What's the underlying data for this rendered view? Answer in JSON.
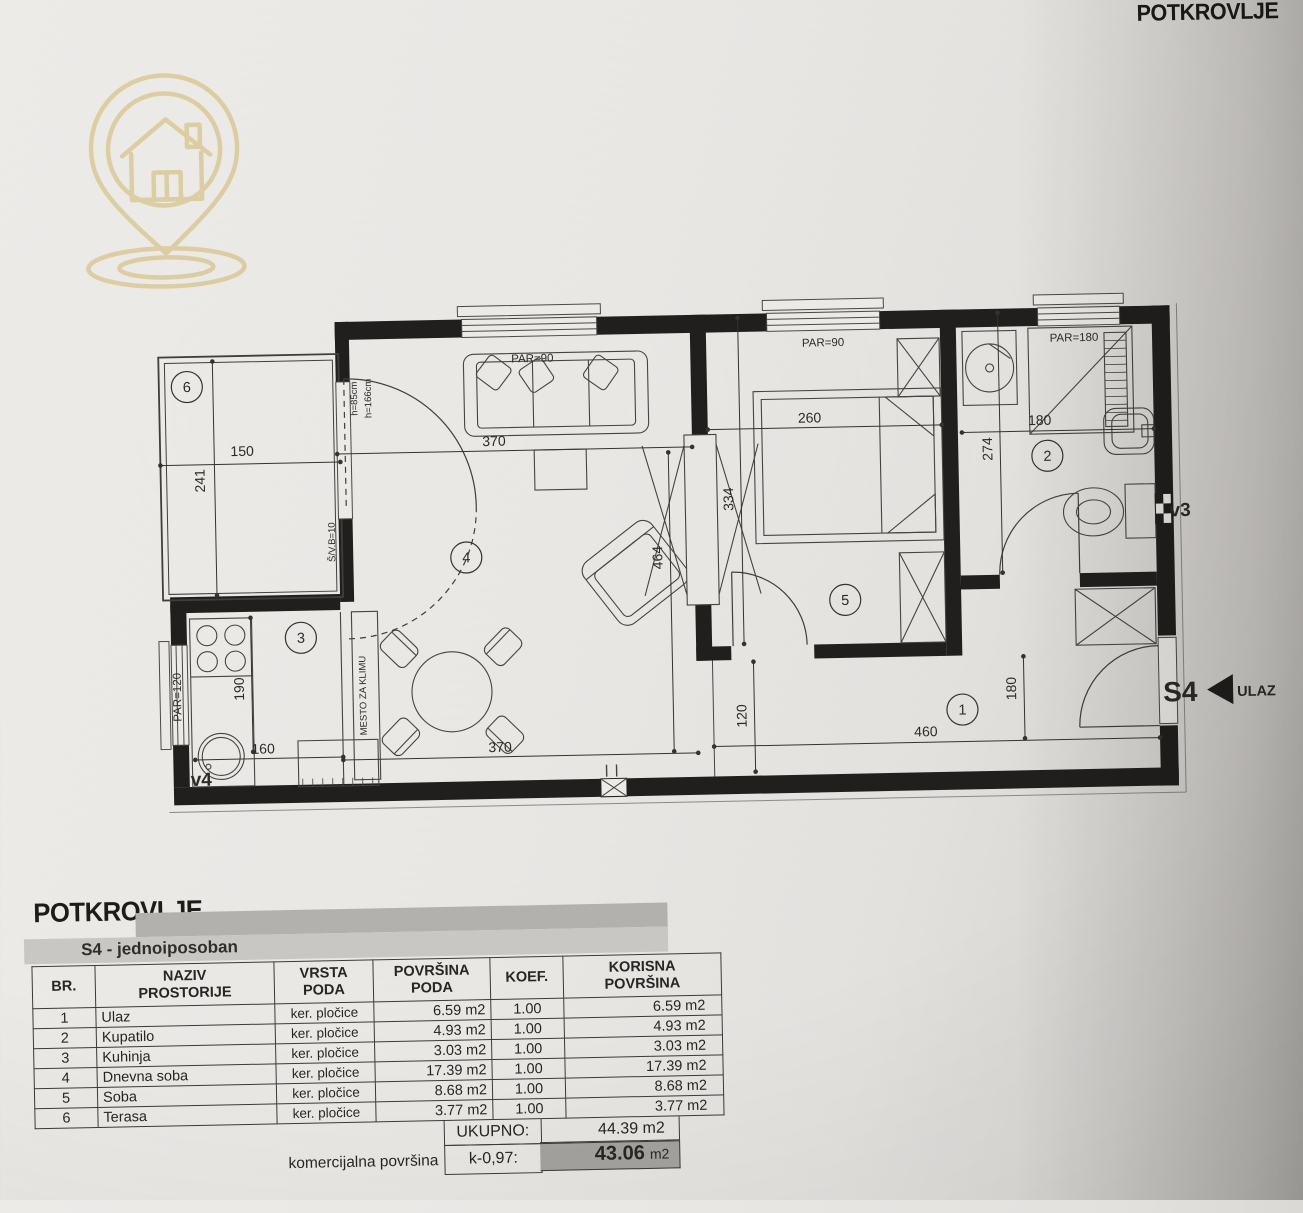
{
  "photo": {
    "paper_color": "#e8e6e3",
    "ink_color": "#232321",
    "accent_gold": "#d9c591"
  },
  "header": {
    "title": "POTKROVLJE"
  },
  "logo": {
    "icon": "house-location-pin-icon"
  },
  "plan": {
    "unit_label": "S4",
    "entrance_label": "ULAZ",
    "vent_left": "v4",
    "vent_right": "v3",
    "ac_box": "MESTO ZA KLIMU",
    "windows": {
      "living": "PAR=90",
      "bedroom": "PAR=90",
      "bath": "PAR=180",
      "kitchen": "PAR=120"
    },
    "door_notes": {
      "parapet": "h=85cm",
      "height": "h=166cm",
      "code": "Š/V.B=10"
    },
    "rooms": {
      "r1": "1",
      "r2": "2",
      "r3": "3",
      "r4": "4",
      "r5": "5",
      "r6": "6"
    },
    "dims": {
      "terrace_w": "150",
      "terrace_h": "241",
      "living_w_top": "370",
      "living_w_bottom": "370",
      "living_h": "464",
      "bedroom_w": "260",
      "bedroom_h": "334",
      "bath_h": "274",
      "bath_w": "180",
      "corridor": "120",
      "hall_w": "460",
      "hall_h": "180",
      "kitchen_h": "190",
      "kitchen_w": "160"
    }
  },
  "section": {
    "heading": "POTKROVLJE",
    "subheading": "S4 - jednoiposoban"
  },
  "table": {
    "headers": [
      {
        "l1": "BR.",
        "l2": ""
      },
      {
        "l1": "NAZIV",
        "l2": "PROSTORIJE"
      },
      {
        "l1": "VRSTA",
        "l2": "PODA"
      },
      {
        "l1": "POVRŠINA",
        "l2": "PODA"
      },
      {
        "l1": "KOEF.",
        "l2": ""
      },
      {
        "l1": "KORISNA",
        "l2": "POVRŠINA"
      }
    ],
    "rows": [
      {
        "br": "1",
        "name": "Ulaz",
        "floor": "ker. pločice",
        "area": "6.59 m2",
        "koef": "1.00",
        "useful": "6.59 m2"
      },
      {
        "br": "2",
        "name": "Kupatilo",
        "floor": "ker. pločice",
        "area": "4.93 m2",
        "koef": "1.00",
        "useful": "4.93 m2"
      },
      {
        "br": "3",
        "name": "Kuhinja",
        "floor": "ker. pločice",
        "area": "3.03 m2",
        "koef": "1.00",
        "useful": "3.03 m2"
      },
      {
        "br": "4",
        "name": "Dnevna soba",
        "floor": "ker. pločice",
        "area": "17.39 m2",
        "koef": "1.00",
        "useful": "17.39 m2"
      },
      {
        "br": "5",
        "name": "Soba",
        "floor": "ker. pločice",
        "area": "8.68 m2",
        "koef": "1.00",
        "useful": "8.68 m2"
      },
      {
        "br": "6",
        "name": "Terasa",
        "floor": "ker. pločice",
        "area": "3.77 m2",
        "koef": "1.00",
        "useful": "3.77 m2"
      }
    ],
    "total_label": "UKUPNO:",
    "total_value": "44.39 m2",
    "commercial_label": "komercijalna površina",
    "commercial_koef": "k-0,97:",
    "commercial_value": "43.06",
    "commercial_unit": "m2"
  }
}
